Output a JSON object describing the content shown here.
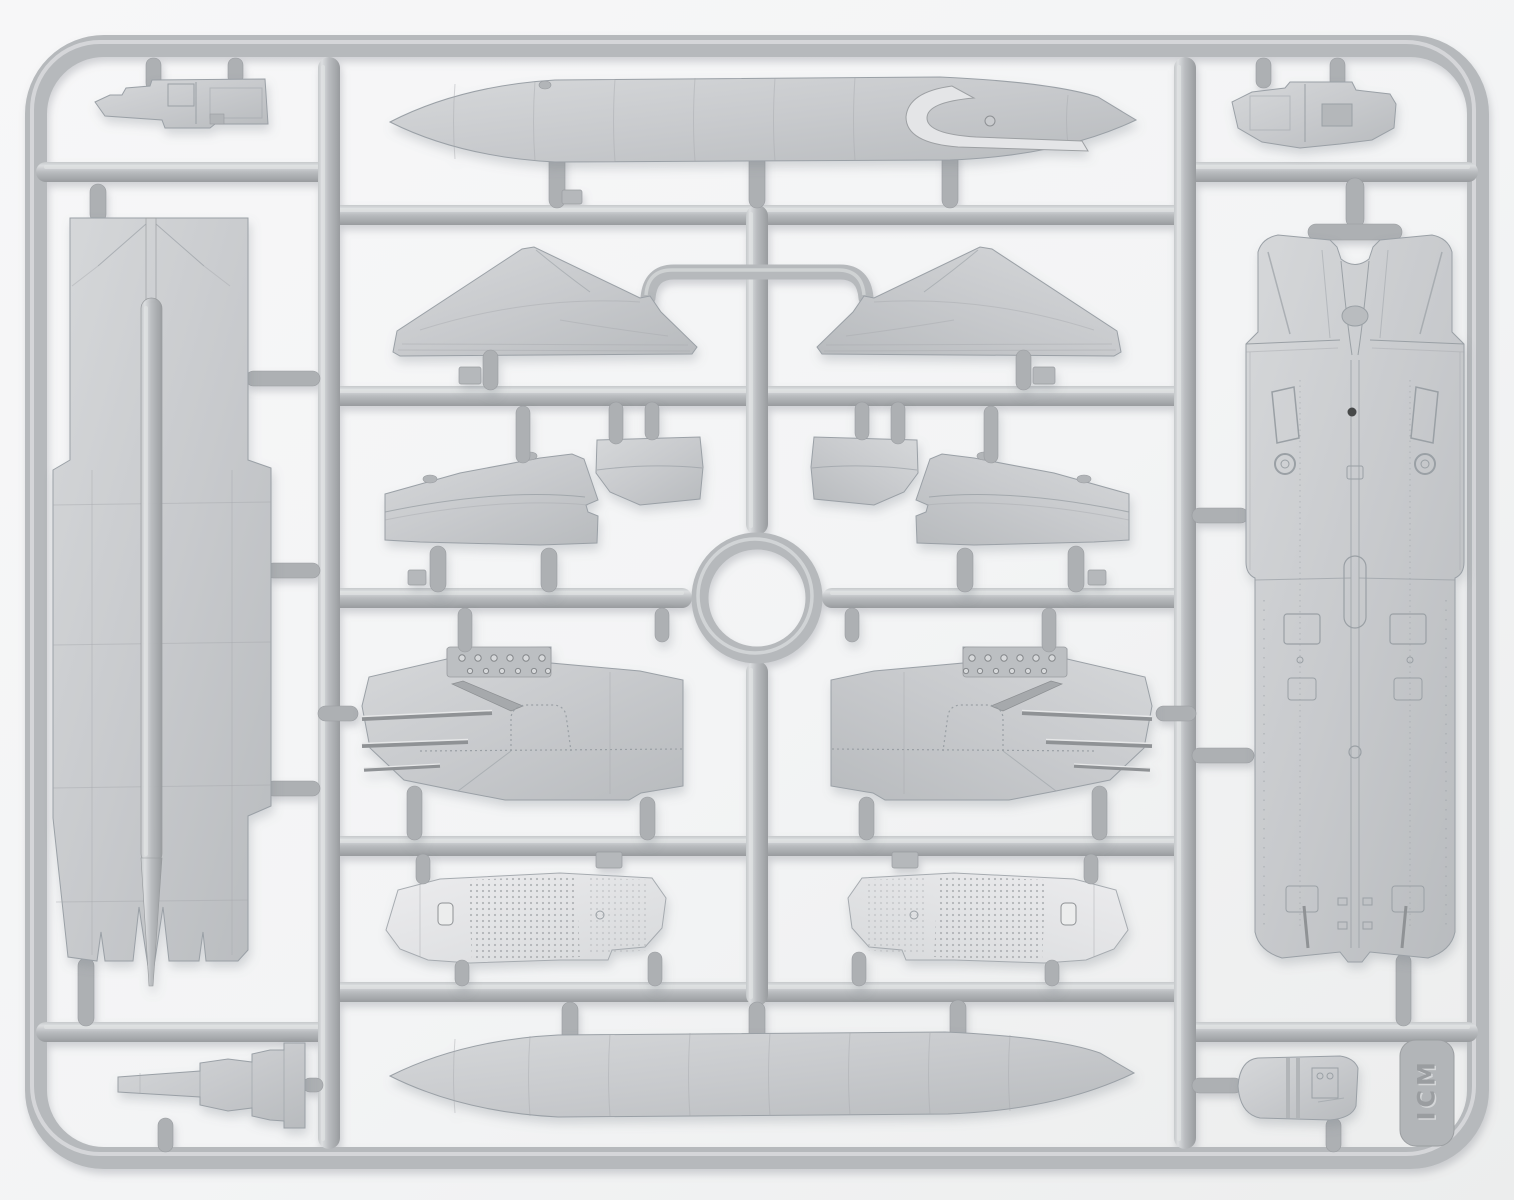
{
  "meta": {
    "subject": "Grey injection-moulded aircraft model kit sprue (frame of plastic parts) photographed on a light background",
    "material": "grey styrene plastic",
    "parts_visible": 20
  },
  "sprue": {
    "tag_logo": "ICM"
  },
  "palette": {
    "background": "#f3f4f5",
    "runner": "#b6b9bc",
    "runner_highlight": "#e0e2e3",
    "part": "#c8cacd",
    "part_light": "#e2e3e5",
    "detail_line": "#9aa0a5",
    "shadow": "#8a8f96",
    "hole": "#46484a"
  },
  "parts": {
    "frame": {
      "label": "Rectangular sprue frame runner"
    },
    "ring_runner": {
      "label": "Circular runner ring (center)"
    },
    "bridge_runner": {
      "label": "U-shaped connecting runner between fins"
    },
    "top_tank": {
      "label": "External fuel tank half — upper, with tail recess"
    },
    "bottom_tank": {
      "label": "External fuel tank half — lower"
    },
    "fin_left": {
      "label": "Vertical tail fin — left"
    },
    "fin_right": {
      "label": "Vertical tail fin — right"
    },
    "ramp_outer_left": {
      "label": "Air intake ramp — outer left"
    },
    "ramp_inner_left": {
      "label": "Air intake ramp — inner left"
    },
    "ramp_inner_right": {
      "label": "Air intake ramp — inner right"
    },
    "ramp_outer_right": {
      "label": "Air intake ramp — outer right"
    },
    "nacelle_left": {
      "label": "Engine nacelle side panel — left"
    },
    "nacelle_right": {
      "label": "Engine nacelle side panel — right"
    },
    "mesh_panel_left": {
      "label": "Perforated intake mesh panel — left"
    },
    "mesh_panel_right": {
      "label": "Perforated intake mesh panel — right"
    },
    "wing_panel": {
      "label": "One-piece wing panel with flap slots"
    },
    "fuselage_underside": {
      "label": "Fuselage underside with intake trunks"
    },
    "equipment_block_top_left": {
      "label": "Equipment block — top-left corner"
    },
    "equipment_block_top_right": {
      "label": "Equipment block — top-right corner"
    },
    "nozzle_block_bottom_left": {
      "label": "Stepped nozzle block — bottom-left corner"
    },
    "pod_bottom_right": {
      "label": "Rounded pod hatch — bottom-right corner"
    },
    "tag": {
      "label": "Embossed manufacturer tag"
    }
  }
}
